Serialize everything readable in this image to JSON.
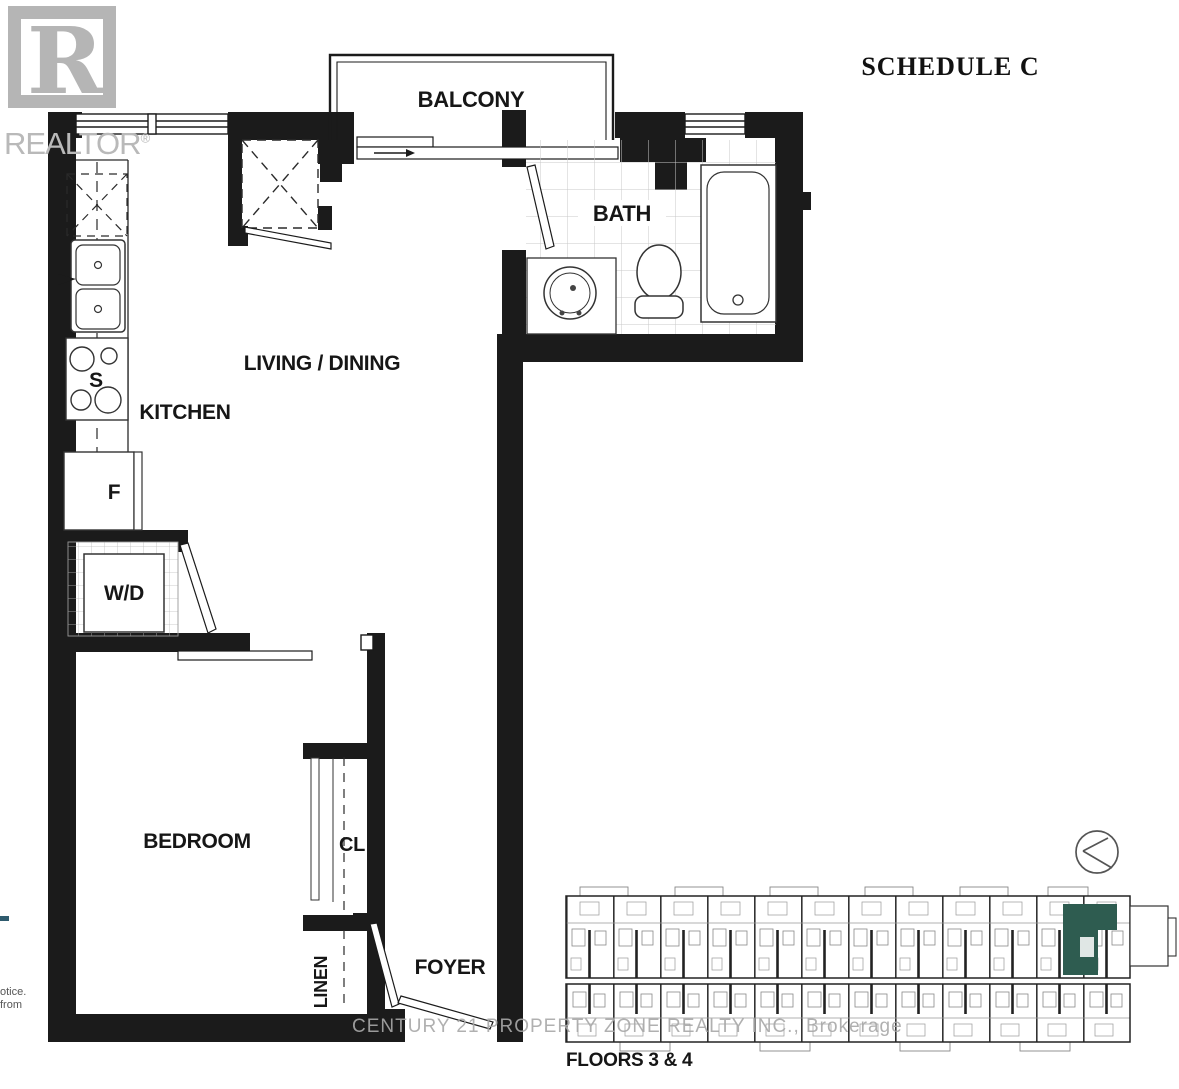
{
  "header": {
    "schedule_label": "SCHEDULE C"
  },
  "realtor_watermark": {
    "logo_letter": "R",
    "wordmark": "REALTOR",
    "registered_symbol": "®"
  },
  "floorplan": {
    "labels": {
      "balcony": "BALCONY",
      "bath": "BATH",
      "kitchen": "KITCHEN",
      "living_dining": "LIVING / DINING",
      "bedroom": "BEDROOM",
      "closet": "CL",
      "linen": "LINEN",
      "foyer": "FOYER",
      "stove": "S",
      "fridge": "F",
      "washer_dryer": "W/D"
    }
  },
  "keyplan": {
    "caption": "FLOORS 3 & 4",
    "highlight_color": "#2e5c50"
  },
  "brokerage_watermark": {
    "text": "CENTURY 21 PROPERTY ZONE REALTY INC., Brokerage"
  },
  "edge_fragments": {
    "line1": "otice.",
    "line2": "from"
  },
  "colors": {
    "wall": "#1b1b1b",
    "keyplan_highlight": "#2e5c50",
    "watermark_gray": "#b9b9b9"
  }
}
